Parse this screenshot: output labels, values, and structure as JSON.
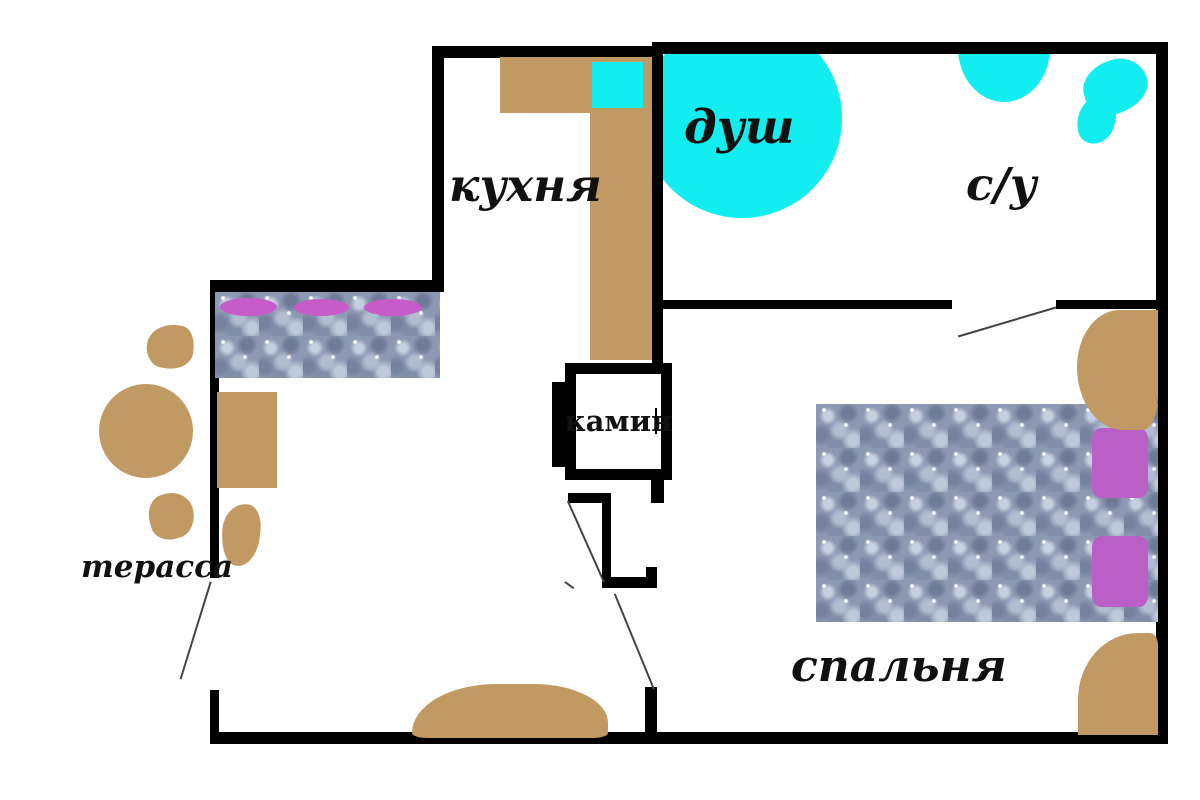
{
  "floor_plan": {
    "title": "apartment-floor-plan",
    "rooms": {
      "kitchen": {
        "label": "кухня"
      },
      "shower": {
        "label": "душ"
      },
      "bathroom": {
        "label": "с/у"
      },
      "bedroom": {
        "label": "спальня"
      },
      "terrace": {
        "label": "терасса"
      },
      "fireplace": {
        "label": "камин"
      }
    },
    "furniture": {
      "kitchen": [
        "counter",
        "sink"
      ],
      "living": [
        "sofa",
        "sofa-pillows",
        "cabinet",
        "chair",
        "entry-rug"
      ],
      "terrace": [
        "round-table",
        "chair-top",
        "chair-bottom"
      ],
      "bathroom": [
        "shower-basin",
        "wash-basin",
        "toilet"
      ],
      "bedroom": [
        "bed",
        "bed-pillows",
        "plant-top",
        "plant-bottom"
      ]
    },
    "colors": {
      "bg": "#ffffff",
      "wall": "#000000",
      "wood": "#c19a63",
      "water": "#12eef0",
      "fabric": "#8d99b3",
      "pillow_sofa": "#c55cc9",
      "pillow_bed": "#b95fc5",
      "swing_line": "#444444",
      "text": "#111111"
    }
  }
}
